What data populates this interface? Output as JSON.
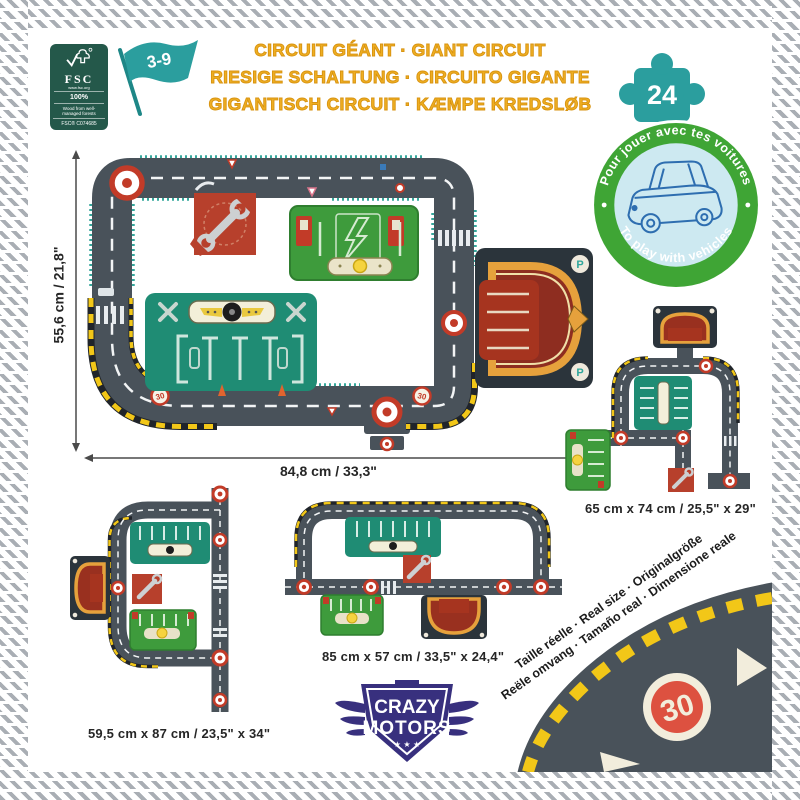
{
  "header": {
    "fsc": {
      "name": "FSC",
      "site": "www.fsc.org",
      "percent": "100%",
      "claim": "Wood from well-managed forests",
      "license": "FSC® C074685"
    },
    "age_range": "3-9",
    "piece_count": "24",
    "title_lines": [
      "CIRCUIT GÉANT · GIANT CIRCUIT",
      "RIESIGE SCHALTUNG · CIRCUITO GIGANTE",
      "GIGANTISCH CIRCUIT · KÆMPE KREDSLØB"
    ]
  },
  "play_badge": {
    "arc_top": "Pour jouer avec tes voitures",
    "arc_bottom": "To play with vehicles"
  },
  "main_circuit": {
    "height_label": "55,6 cm / 21,8\"",
    "width_label": "84,8 cm / 33,3\"",
    "speed_sign": "30",
    "parking_letter": "P"
  },
  "variants": {
    "left": {
      "label": "59,5 cm x 87 cm / 23,5\" x 34\""
    },
    "center": {
      "label": "85 cm x 57 cm / 33,5\" x 24,4\""
    },
    "right": {
      "label": "65 cm x 74 cm / 25,5\" x 29\""
    }
  },
  "brand": {
    "name_top": "CRAZY",
    "name_bottom": "MOTORS",
    "stars": "★ ★ ★"
  },
  "real_size": {
    "line1": "Taille réelle · Real size · Originalgröße",
    "line2": "Reële omvang · Tamaño real · Dimensione reale",
    "speed_sign": "30"
  },
  "colors": {
    "title_gold": "#EEAE22",
    "teal": "#2B9E9E",
    "badge_green": "#3FA535",
    "road_slate": "#49525A",
    "hazard_yellow": "#F2C718",
    "garage_teal": "#1F8C74",
    "charge_green": "#3E9B3C",
    "piece_red": "#B7402C",
    "parking_maroon": "#99301F",
    "brand_indigo": "#38307E",
    "sign_red": "#DD5140"
  }
}
